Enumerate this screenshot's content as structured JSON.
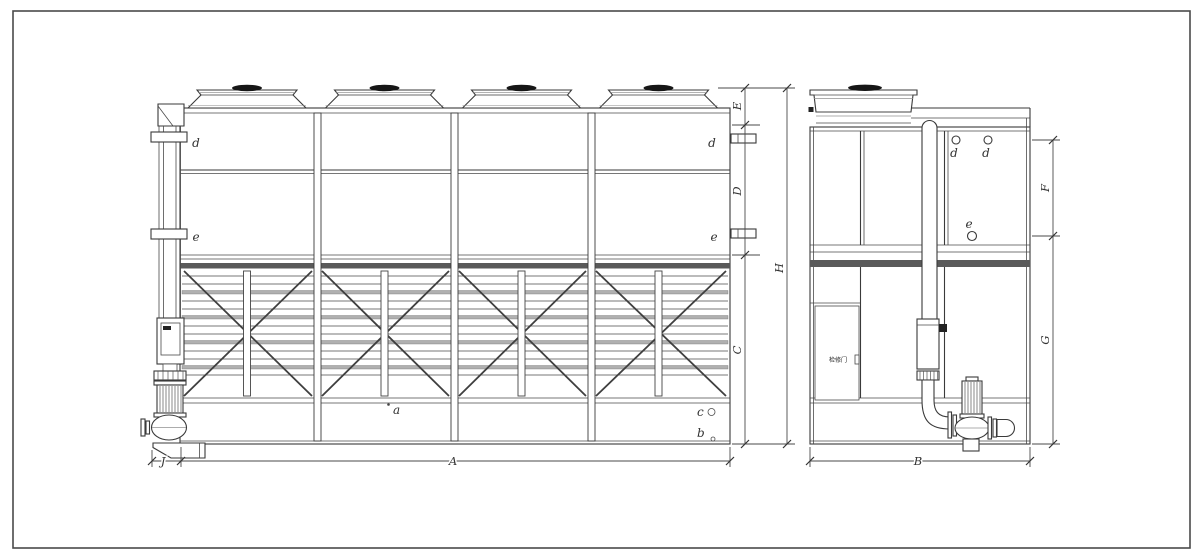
{
  "drawing": {
    "front_view": {
      "panel_labels": {
        "top_left": "d",
        "bottom_left": "e",
        "top_right": "d",
        "bottom_right": "e"
      },
      "basin_labels": {
        "a": "a",
        "b": "b",
        "c": "c"
      },
      "dims": {
        "fan_height": "E",
        "casing_section": "D",
        "lower_section": "C",
        "total_height": "H",
        "overall_width": "A",
        "pump_offset": "J"
      }
    },
    "side_view": {
      "connection_labels": {
        "inlet_left": "d",
        "inlet_right": "d",
        "outlet": "e"
      },
      "access_door_label": "检修门",
      "dims": {
        "upper_section": "F",
        "lower_section": "G",
        "overall_depth": "B"
      }
    },
    "colors": {
      "ink": "#3a3a3a",
      "background": "#ffffff",
      "louver_band": "#b0b0b0",
      "fan_cap": "#161616"
    }
  }
}
